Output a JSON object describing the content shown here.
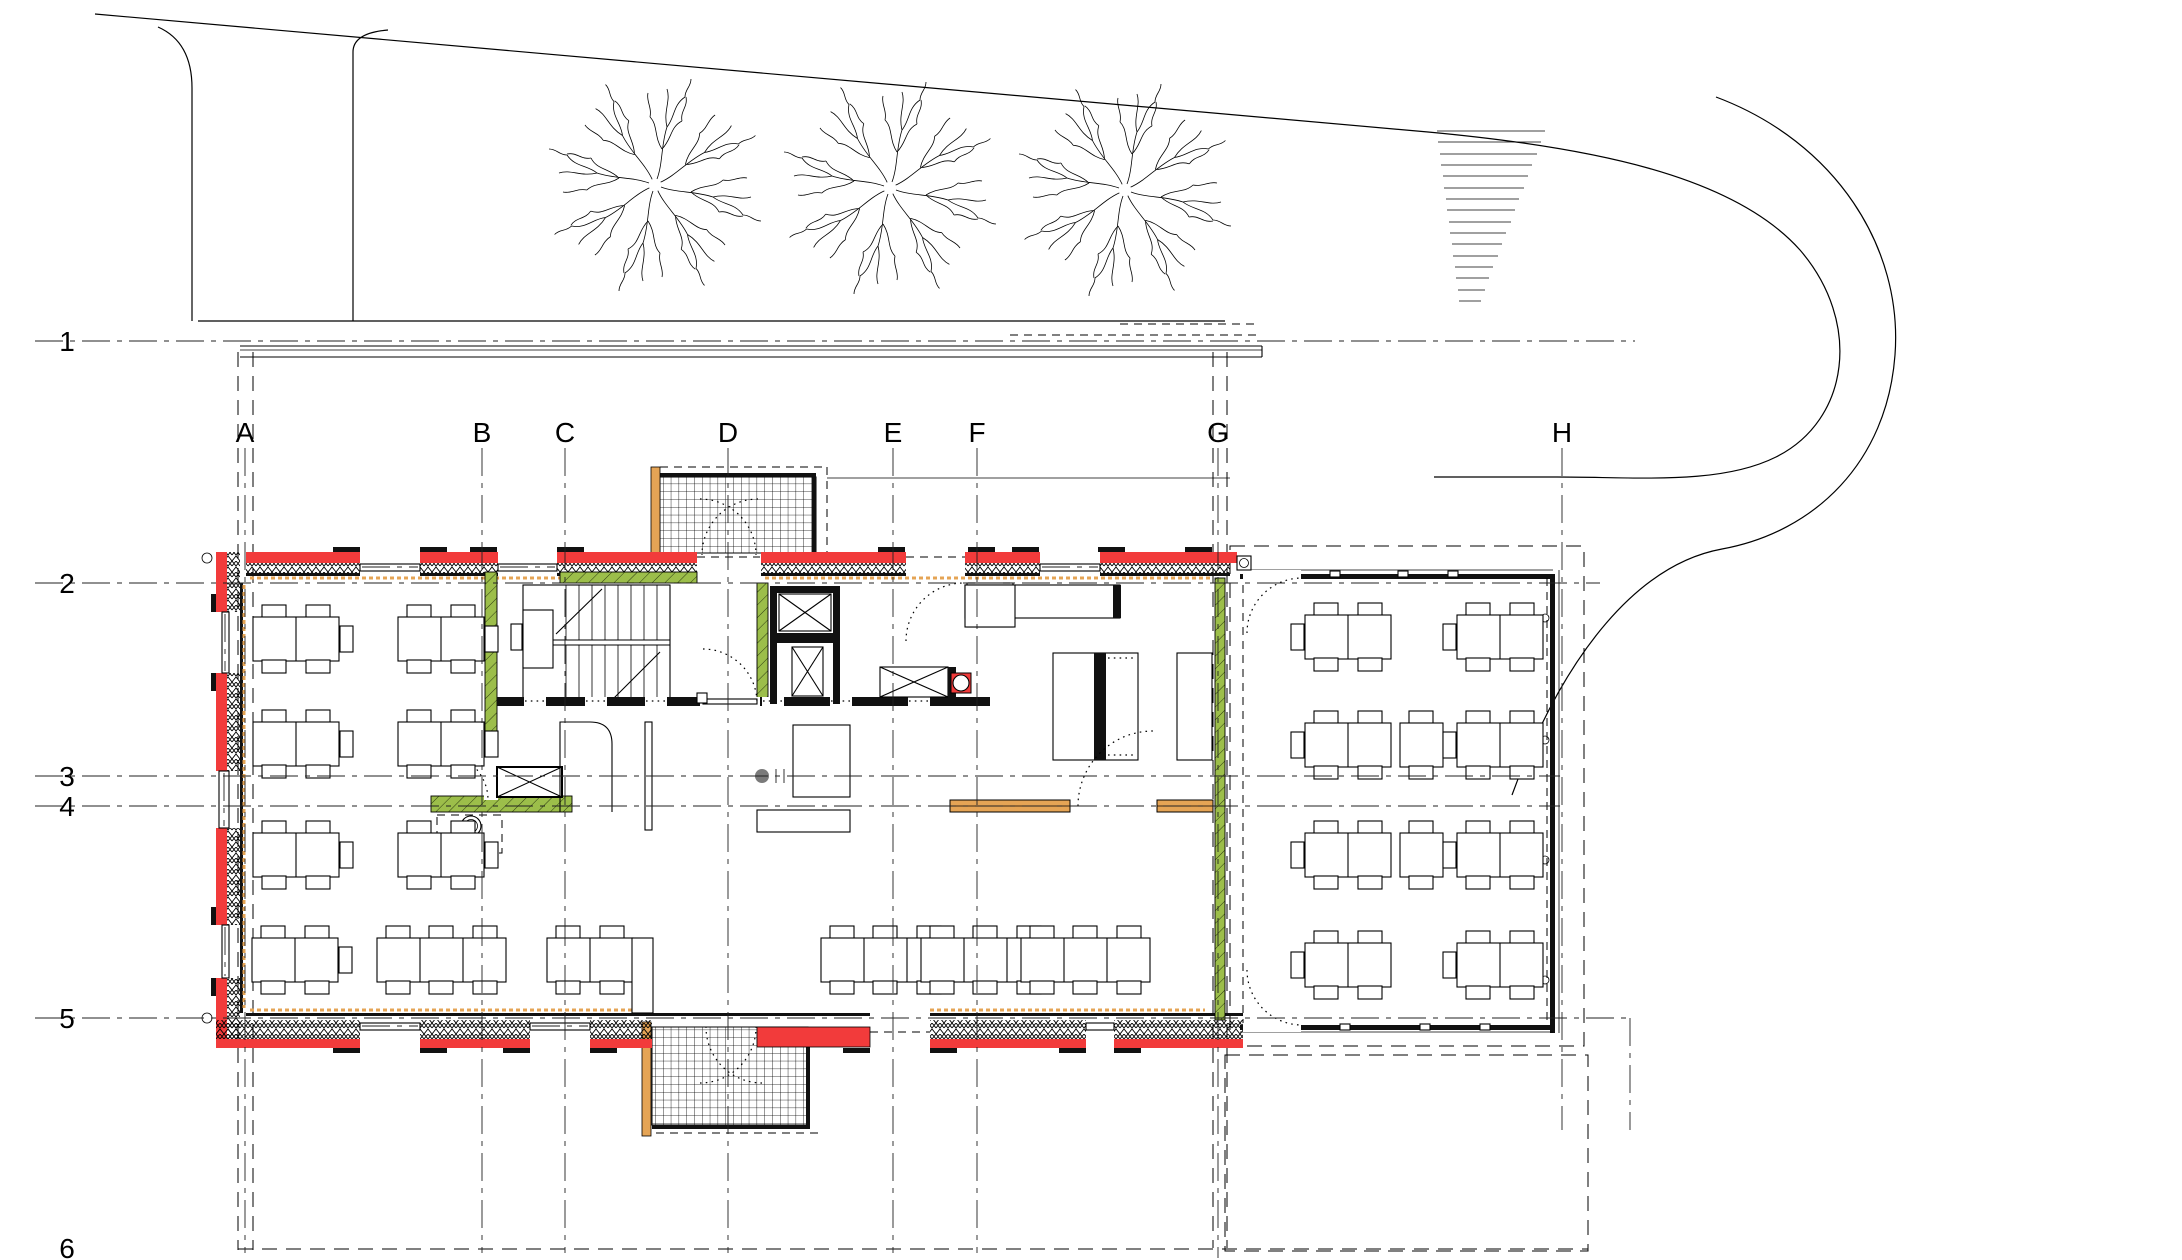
{
  "drawing": {
    "kind": "architectural ground-floor plan",
    "visible_text_only_grid_labels": true
  },
  "grid": {
    "columns": [
      {
        "label": "A"
      },
      {
        "label": "B"
      },
      {
        "label": "C"
      },
      {
        "label": "D"
      },
      {
        "label": "E"
      },
      {
        "label": "F"
      },
      {
        "label": "G"
      },
      {
        "label": "H"
      }
    ],
    "rows": [
      {
        "label": "1"
      },
      {
        "label": "2"
      },
      {
        "label": "3"
      },
      {
        "label": "4"
      },
      {
        "label": "5"
      },
      {
        "label": "6"
      }
    ]
  },
  "markers": {
    "corner_symbol": "o"
  },
  "colors": {
    "background": "#ffffff",
    "wall_red": "#f23b3b",
    "wall_green": "#9cbe4a",
    "wood_orange": "#e5a455",
    "line_black": "#000000",
    "survey_dot_gray": "#7a7a7a"
  },
  "site": {
    "trees": 3,
    "road_curve": "hairpin at right",
    "external_steps_lines": 16
  },
  "furniture": {
    "four_seat_double_tables_left_room": 6,
    "four_seat_double_tables_annex": 8,
    "single_square_tables_annex": 2,
    "six_seat_long_tables_south_band": 4,
    "four_seat_double_tables_south_band": 2
  }
}
